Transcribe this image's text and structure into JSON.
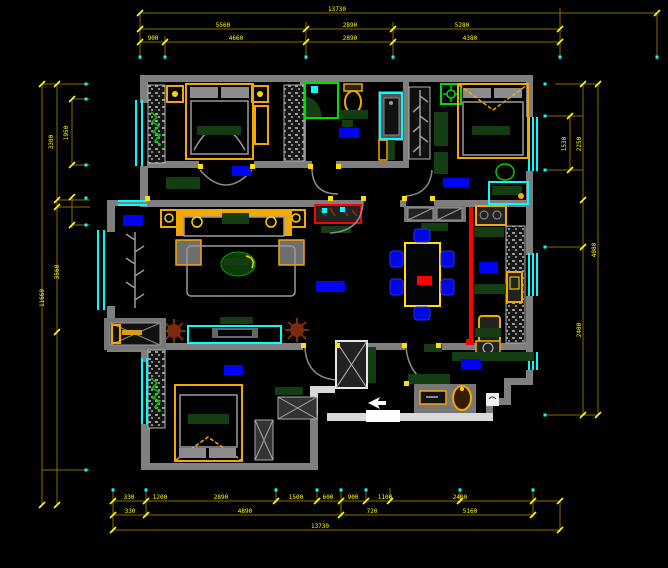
{
  "drawing": {
    "type": "apartment-floor-plan",
    "background": "#000000",
    "colors": {
      "dimension_line": "#8a6d00",
      "dimension_text": "#ffff00",
      "wall": "#7f7f7f",
      "window": "#00ffff",
      "furniture_accent": "#f5a800",
      "room_label_block": "#0004f0",
      "kitchen_divider": "#ff0000",
      "counter_green": "#143d14",
      "plant_brown": "#7a2c0c"
    }
  },
  "dims": {
    "top": {
      "row1": [
        "13730"
      ],
      "row2": [
        "5560",
        "2890",
        "5280"
      ],
      "row3": [
        "900",
        "4660",
        "2890",
        "4380"
      ]
    },
    "bottom": {
      "rowA": [
        "330",
        "1200",
        "2890",
        "1500",
        "600",
        "900",
        "1100",
        "2400"
      ],
      "rowB": [
        "330",
        "4890",
        "720",
        "5160"
      ],
      "rowC": [
        "13730"
      ]
    },
    "left": {
      "outer": [
        "11660"
      ],
      "mid": [
        "3300",
        "3560"
      ],
      "inner": [
        "1950"
      ]
    },
    "right": {
      "inner": [
        "1530"
      ],
      "mid": [
        "2250",
        "2400"
      ],
      "outer": [
        "4080"
      ]
    }
  }
}
